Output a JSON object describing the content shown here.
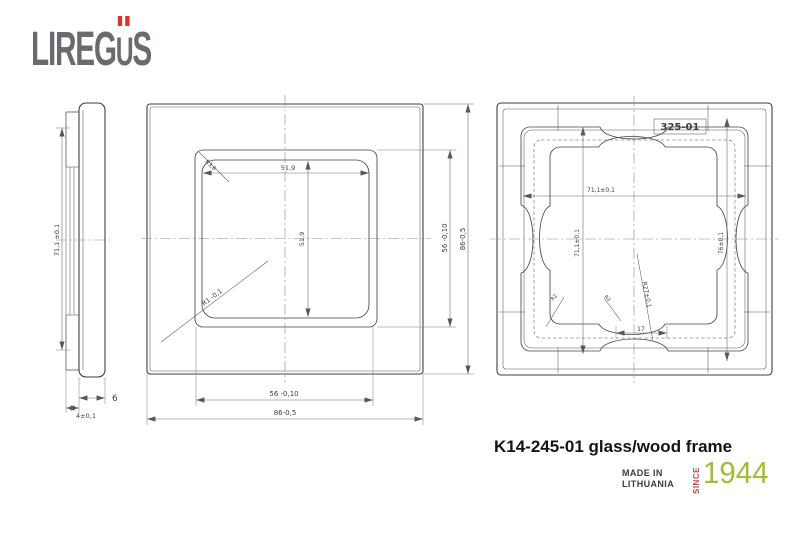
{
  "logo": {
    "part1": "LIREG",
    "u": "U",
    "part2": "S"
  },
  "side_view": {
    "height": "71,1 ±0,1",
    "insert_depth": "4±0,1",
    "frame_depth": "6"
  },
  "front_view": {
    "window_width": "51,9",
    "window_height": "51,9",
    "corner_radius": "R3,8",
    "edge_radius": "R1 -0,1",
    "aperture_height": "56 -0,10",
    "overall_height": "86-0,5",
    "aperture_width": "56 -0,10",
    "overall_width": "86-0,5"
  },
  "back_view": {
    "part_label": "325-01",
    "inner_width": "71,1±0,1",
    "inner_height": "71,1±0,1",
    "mount_height": "76±0,1",
    "corner_radius_large": "R27±0,1",
    "notch_width": "17",
    "fillet_small": "R2",
    "fillet_medium": "R3"
  },
  "title_block": {
    "part_title": "K14-245-01 glass/wood frame",
    "made_in_line1": "MADE IN",
    "made_in_line2": "LITHUANIA",
    "since_label": "SINCE",
    "year": "1944"
  },
  "colors": {
    "line": "#3d3f42",
    "dimension": "#6a6d70",
    "logo_gray": "#696c6f",
    "accent_red": "#d6362f",
    "since_red": "#b0524a",
    "year_green": "#a6b940",
    "title_text": "#141414"
  }
}
